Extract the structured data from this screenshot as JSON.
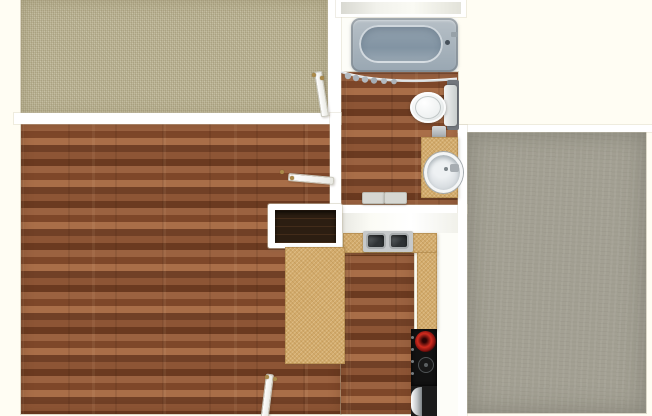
{
  "scene": {
    "type": "apartment-floor-plan-top-view",
    "background_color": "#fffdf3",
    "wall_color": "#ffffff"
  },
  "rooms": {
    "bedroom_left": {
      "label": "Bedroom with beige carpet",
      "floor": "beige-carpet",
      "color": "#c2bb9e"
    },
    "living_room": {
      "label": "Living room with hardwood floor",
      "floor": "hardwood",
      "color": "#905736"
    },
    "bathroom": {
      "label": "Bathroom with hardwood floor",
      "floor": "hardwood",
      "color": "#905736"
    },
    "entry_hall": {
      "label": "Hall landing with white floor",
      "floor": "white",
      "color": "#f4f4ee"
    },
    "kitchen": {
      "label": "Kitchen with hardwood floor",
      "floor": "hardwood",
      "color": "#905736"
    },
    "bedroom_right": {
      "label": "Bedroom with gray carpet",
      "floor": "gray-carpet",
      "color": "#a3a093"
    },
    "closet": {
      "label": "Closet shelf above bathtub",
      "color": "#e9e9e1"
    }
  },
  "fixtures": {
    "bathtub": {
      "label": "Bathtub",
      "color": "#9fb0bd"
    },
    "shower_curtain": {
      "label": "Shower curtain on rod",
      "color": "#c6cbd0"
    },
    "toilet": {
      "label": "Toilet with tank",
      "color": "#eef1f1"
    },
    "towel_holder": {
      "label": "Paper / towel holder",
      "color": "#b8bcbf"
    },
    "vanity": {
      "label": "Vanity counter with round sink",
      "color": "#d3ab6c"
    },
    "bath_mat": {
      "label": "Two-piece bath mat",
      "color": "#d6d7d2"
    },
    "kitchen_sink": {
      "label": "Double-basin kitchen sink",
      "color": "#44484a"
    },
    "kitchen_counter": {
      "label": "Kitchen counter",
      "color": "#d3ab6c"
    },
    "breakfast_bar": {
      "label": "Dark breakfast bar top",
      "color": "#2c1e12"
    },
    "peninsula": {
      "label": "Peninsula counter",
      "color": "#d3ab6c"
    },
    "range": {
      "label": "Range with hot red burner and oven",
      "color": "#141414",
      "burner_color": "#cf2b1e"
    },
    "doors": {
      "label": "Open swinging door",
      "color": "#ffffff",
      "hinge_color": "#ab8a4a",
      "count": 3
    }
  }
}
